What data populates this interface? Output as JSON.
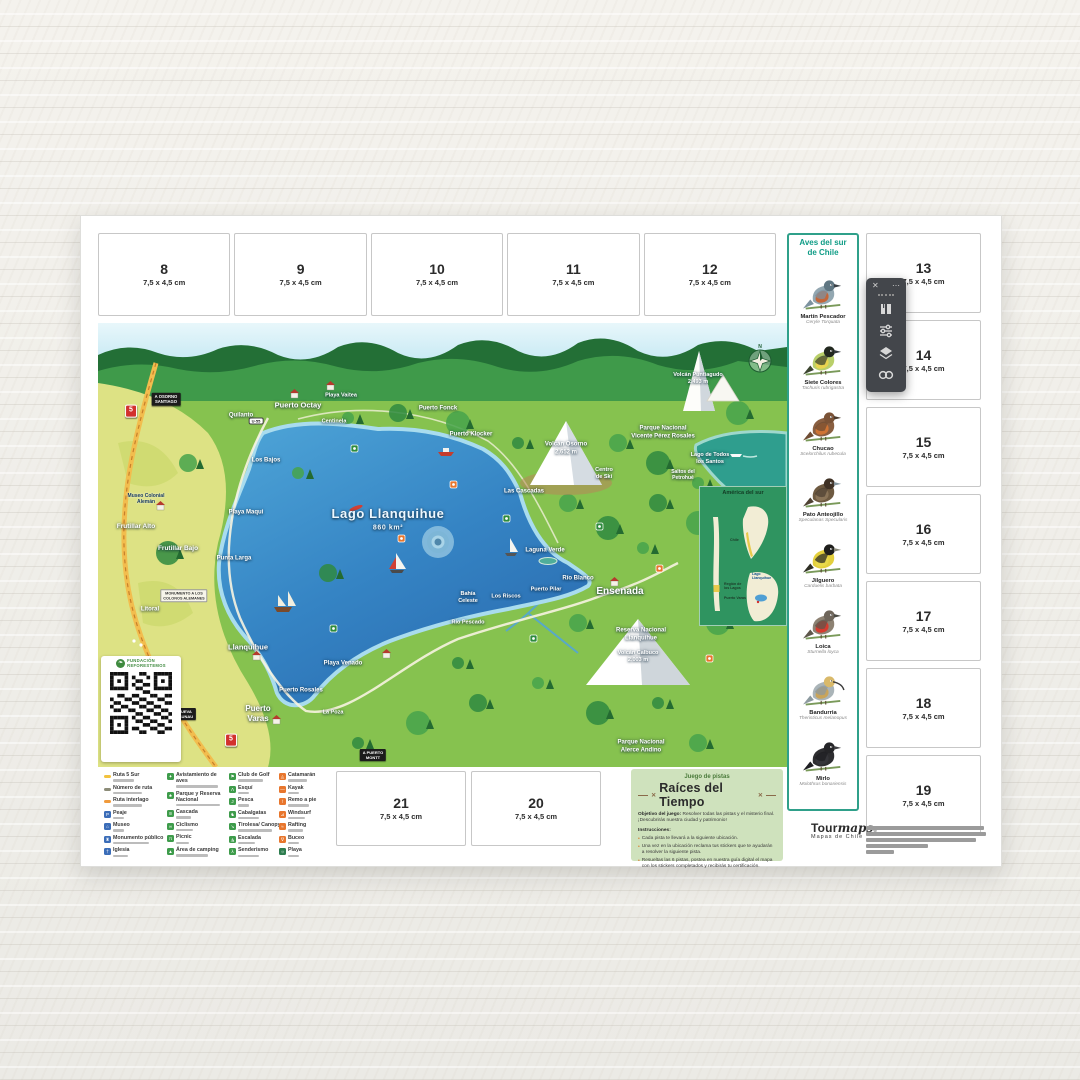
{
  "stickers": {
    "size_label": "7,5 x 4,5 cm",
    "top": [
      "8",
      "9",
      "10",
      "11",
      "12"
    ],
    "right": [
      "13",
      "14",
      "15",
      "16",
      "17",
      "18",
      "19"
    ],
    "bottom": [
      {
        "num": "21",
        "x": 255,
        "y": 555
      },
      {
        "num": "20",
        "x": 390,
        "y": 555
      }
    ]
  },
  "birds_panel": {
    "title": "Aves  del sur\nde Chile",
    "accent": "#0f9c86",
    "birds": [
      {
        "name": "Martín Pescador",
        "sci": "Ceryle Torquata",
        "colors": {
          "body": "#93a7b1",
          "head": "#5f7682",
          "chest": "#c4663a",
          "wing": "#7d92a0",
          "beak": "#3a3f44"
        }
      },
      {
        "name": "Siete Colores",
        "sci": "Tachuris rubrigastra",
        "colors": {
          "body": "#b9cf6a",
          "head": "#22281f",
          "chest": "#e9d44f",
          "wing": "#3c4530",
          "beak": "#33383c"
        }
      },
      {
        "name": "Chucao",
        "sci": "Scelorchilus rubecula",
        "colors": {
          "body": "#8a5f41",
          "head": "#7a5236",
          "chest": "#cf7434",
          "wing": "#6f4c33",
          "beak": "#4a3a2c"
        }
      },
      {
        "name": "Pato Anteojillo",
        "sci": "Speculanas Specularis",
        "colors": {
          "body": "#6e5a41",
          "head": "#3f3125",
          "chest": "#8a7458",
          "wing": "#4f4233",
          "beak": "#8899a2"
        }
      },
      {
        "name": "Jilguero",
        "sci": "Carduelis barbata",
        "colors": {
          "body": "#e3cf3c",
          "head": "#1e1e1c",
          "chest": "#e8d84a",
          "wing": "#2e2e24",
          "beak": "#8a8a7a"
        }
      },
      {
        "name": "Loica",
        "sci": "Sturnella loyca",
        "colors": {
          "body": "#8d8273",
          "head": "#6e655a",
          "chest": "#d63b2f",
          "wing": "#5f574c",
          "beak": "#4a4a44"
        }
      },
      {
        "name": "Bandurria",
        "sci": "Theristicus melanopus",
        "colors": {
          "body": "#aab4b8",
          "head": "#d9b96a",
          "chest": "#c9a45a",
          "wing": "#8d9aa0",
          "beak": "#3c3c3c"
        }
      },
      {
        "name": "Mirlo",
        "sci": "Molothrus bonariensis",
        "colors": {
          "body": "#2d2d30",
          "head": "#242427",
          "chest": "#35353a",
          "wing": "#1e1e22",
          "beak": "#3f3f42"
        }
      }
    ]
  },
  "map": {
    "labels": [
      {
        "t": "A OSORNO\nSANTIAGO",
        "x": 68,
        "y": 76,
        "s": 4.2,
        "v": "sign"
      },
      {
        "t": "5",
        "x": 33,
        "y": 88,
        "s": 7,
        "v": "shield"
      },
      {
        "t": "5",
        "x": 133,
        "y": 417,
        "s": 7,
        "v": "shield"
      },
      {
        "t": "U-55",
        "x": 158,
        "y": 98,
        "s": 4,
        "v": "badge"
      },
      {
        "t": "Quilanto",
        "x": 143,
        "y": 93,
        "s": 6
      },
      {
        "t": "Puerto Octay",
        "x": 200,
        "y": 82,
        "s": 7.5
      },
      {
        "t": "Playa Vaitea",
        "x": 243,
        "y": 73,
        "s": 5.5
      },
      {
        "t": "Centinela",
        "x": 236,
        "y": 99,
        "s": 5.5
      },
      {
        "t": "Puerto Fonck",
        "x": 340,
        "y": 86,
        "s": 6
      },
      {
        "t": "Puerto Klocker",
        "x": 373,
        "y": 112,
        "s": 6
      },
      {
        "t": "Los Bajos",
        "x": 168,
        "y": 138,
        "s": 6
      },
      {
        "t": "Playa Maqui",
        "x": 148,
        "y": 190,
        "s": 6
      },
      {
        "t": "Museo Colonial\nAlemán",
        "x": 48,
        "y": 176,
        "s": 5,
        "v": "dark"
      },
      {
        "t": "Frutillar Alto",
        "x": 38,
        "y": 204,
        "s": 6.5
      },
      {
        "t": "Frutillar Bajo",
        "x": 80,
        "y": 226,
        "s": 6.5
      },
      {
        "t": "Punta Larga",
        "x": 136,
        "y": 236,
        "s": 6
      },
      {
        "t": "Litoral",
        "x": 52,
        "y": 287,
        "s": 6
      },
      {
        "t": "MONUMENTO A LOS\nCOLONOS ALEMANES",
        "x": 86,
        "y": 273,
        "s": 3.8,
        "v": "sign-light"
      },
      {
        "t": "Llanquihue",
        "x": 150,
        "y": 324,
        "s": 7.5
      },
      {
        "t": "Playa Venado",
        "x": 245,
        "y": 341,
        "s": 6
      },
      {
        "t": "Puerto Rosales",
        "x": 203,
        "y": 368,
        "s": 6
      },
      {
        "t": "Puerto\nVaras",
        "x": 160,
        "y": 391,
        "s": 8
      },
      {
        "t": "La Poza",
        "x": 235,
        "y": 390,
        "s": 5.5
      },
      {
        "t": "A NUEVA\nBRAUNAU",
        "x": 85,
        "y": 391,
        "s": 4,
        "v": "sign"
      },
      {
        "t": "A PUERTO\nMONTT",
        "x": 275,
        "y": 432,
        "s": 4,
        "v": "sign"
      },
      {
        "t": "Bahía\nCeleste",
        "x": 370,
        "y": 275,
        "s": 5.5
      },
      {
        "t": "Los Riscos",
        "x": 408,
        "y": 274,
        "s": 5.5
      },
      {
        "t": "Puerto Pilar",
        "x": 448,
        "y": 267,
        "s": 5.5
      },
      {
        "t": "Río Blanco",
        "x": 480,
        "y": 256,
        "s": 6
      },
      {
        "t": "Laguna Verde",
        "x": 447,
        "y": 228,
        "s": 6
      },
      {
        "t": "Río Pescado",
        "x": 370,
        "y": 300,
        "s": 5.5
      },
      {
        "t": "Ensenada",
        "x": 522,
        "y": 269,
        "s": 10
      },
      {
        "t": "Las Cascadas",
        "x": 426,
        "y": 169,
        "s": 6
      },
      {
        "t": "Volcán Osorno\n2.652 m",
        "x": 468,
        "y": 126,
        "s": 6
      },
      {
        "t": "Centro\nde Ski",
        "x": 506,
        "y": 151,
        "s": 5.5
      },
      {
        "t": "Volcán Puntiagudo\n2.493 m",
        "x": 600,
        "y": 56,
        "s": 5.5
      },
      {
        "t": "Parque Nacional\nVicente Pérez Rosales",
        "x": 565,
        "y": 110,
        "s": 6
      },
      {
        "t": "Lago de Todos\nlos Santos",
        "x": 612,
        "y": 136,
        "s": 5.5
      },
      {
        "t": "Saltos del\nPetrohué",
        "x": 585,
        "y": 152,
        "s": 5
      },
      {
        "t": "Reserva Nacional\nLlanquihue",
        "x": 543,
        "y": 312,
        "s": 6
      },
      {
        "t": "Volcán Calbuco\n2.003 m",
        "x": 540,
        "y": 334,
        "s": 5.5
      },
      {
        "t": "Parque Nacional\nAlerce Andino",
        "x": 543,
        "y": 424,
        "s": 6
      },
      {
        "t": "Lago Llanquihue",
        "x": 290,
        "y": 191,
        "s": 13,
        "v": "big"
      },
      {
        "t": "860 km²",
        "x": 290,
        "y": 206,
        "s": 7,
        "v": "big"
      }
    ],
    "inset": {
      "title": "América del sur",
      "country": "Chile",
      "region": "Región de\nlos Lagos",
      "city": "Puerto Varas",
      "lake": "Lago\nLlanquihue"
    },
    "qr": {
      "org_line1": "FUNDACIÓN",
      "org_line2": "REFORESTEMOS",
      "leaf_glyph": "❧"
    }
  },
  "legend": {
    "columns": [
      {
        "x": 3,
        "items": [
          {
            "label": "Ruta 5 Sur",
            "icon": "line",
            "color": "#f2c23e"
          },
          {
            "label": "Número de ruta",
            "icon": "line",
            "color": "#8c8c78"
          },
          {
            "label": "Ruta interlago",
            "icon": "line",
            "color": "#f09a3c"
          },
          {
            "label": "Peaje",
            "icon": "box",
            "color": "#3b6db8",
            "glyph": "P"
          },
          {
            "label": "Museo",
            "icon": "box",
            "color": "#3b6db8",
            "glyph": "⌂"
          },
          {
            "label": "Monumento público",
            "icon": "box",
            "color": "#3b6db8",
            "glyph": "♜"
          },
          {
            "label": "Iglesia",
            "icon": "box",
            "color": "#3b6db8",
            "glyph": "†"
          }
        ]
      },
      {
        "x": 66,
        "items": [
          {
            "label": "Avistamiento de aves",
            "icon": "box",
            "color": "#3e9c4b",
            "glyph": "✦"
          },
          {
            "label": "Parque y Reserva Nacional",
            "icon": "box",
            "color": "#3e9c4b",
            "glyph": "♣"
          },
          {
            "label": "Cascada",
            "icon": "box",
            "color": "#3e9c4b",
            "glyph": "≋"
          },
          {
            "label": "Ciclismo",
            "icon": "box",
            "color": "#3e9c4b",
            "glyph": "∞"
          },
          {
            "label": "Picnic",
            "icon": "box",
            "color": "#3e9c4b",
            "glyph": "π"
          },
          {
            "label": "Área de camping",
            "icon": "box",
            "color": "#3e9c4b",
            "glyph": "▲"
          }
        ]
      },
      {
        "x": 128,
        "items": [
          {
            "label": "Club de Golf",
            "icon": "box",
            "color": "#3e9c4b",
            "glyph": "⚑"
          },
          {
            "label": "Esquí",
            "icon": "box",
            "color": "#3e9c4b",
            "glyph": "Λ"
          },
          {
            "label": "Pesca",
            "icon": "box",
            "color": "#3e9c4b",
            "glyph": "J"
          },
          {
            "label": "Cabalgatas",
            "icon": "box",
            "color": "#3e9c4b",
            "glyph": "♞"
          },
          {
            "label": "Tirolesa/ Canopy",
            "icon": "box",
            "color": "#3e9c4b",
            "glyph": "↘"
          },
          {
            "label": "Escalada",
            "icon": "box",
            "color": "#3e9c4b",
            "glyph": "◮"
          },
          {
            "label": "Senderismo",
            "icon": "box",
            "color": "#3e9c4b",
            "glyph": "λ"
          }
        ]
      },
      {
        "x": 178,
        "items": [
          {
            "label": "Catamarán",
            "icon": "box",
            "color": "#e8762d",
            "glyph": "◬"
          },
          {
            "label": "Kayak",
            "icon": "box",
            "color": "#e8762d",
            "glyph": "—"
          },
          {
            "label": "Remo a pie",
            "icon": "box",
            "color": "#e8762d",
            "glyph": "⊺"
          },
          {
            "label": "Windsurf",
            "icon": "box",
            "color": "#e8762d",
            "glyph": "⊿"
          },
          {
            "label": "Rafting",
            "icon": "box",
            "color": "#e8762d",
            "glyph": "≈"
          },
          {
            "label": "Buceo",
            "icon": "box",
            "color": "#e8762d",
            "glyph": "∇"
          },
          {
            "label": "Playa",
            "icon": "box",
            "color": "#2e7d4f",
            "glyph": "☼"
          }
        ]
      }
    ]
  },
  "game": {
    "kicker": "Juego de pistas",
    "title": "Raíces del Tiempo",
    "objective_label": "Objetivo del juego:",
    "objective_text": " Resolver todas las pistas y el misterio final. ¡Descubrirás nuestra ciudad y patrimonio!",
    "instructions_label": "Instrucciones:",
    "bullets": [
      "Cada pista te llevará a la siguiente ubicación.",
      "Una vez en la ubicación reclama tus stickers que te ayudarán a resolver la siguiente pista.",
      "Resueltas las 6 pistas, postea en nuestra guía digital el mapa con los stickers completados y recibirás tu certificación."
    ],
    "bullet_glyph": "•"
  },
  "footer": {
    "brand_a": "Tour",
    "brand_b": "maps",
    "reg": "®",
    "tagline": "Mapas de Chile",
    "bars": [
      118,
      120,
      110,
      62,
      28
    ]
  },
  "toolbar": {
    "close_glyph": "✕",
    "more_glyph": "⋯",
    "buttons": [
      "pages",
      "adjust",
      "layers",
      "link"
    ]
  }
}
